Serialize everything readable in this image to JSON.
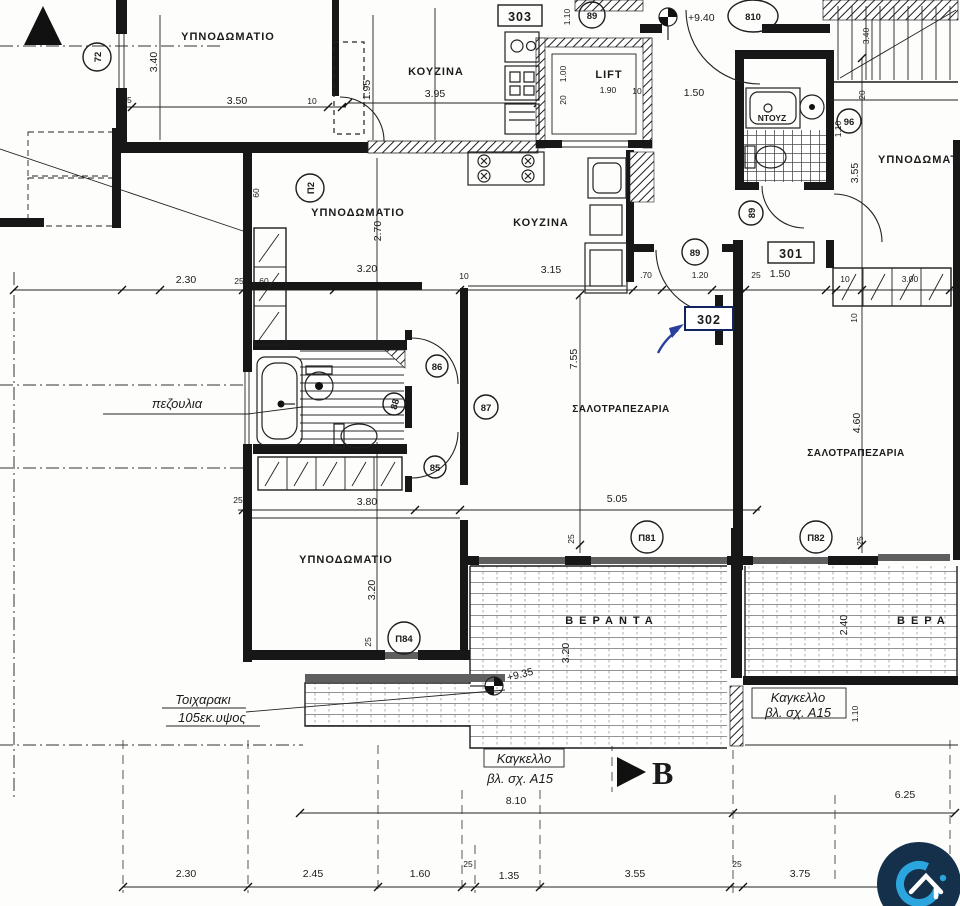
{
  "plan": {
    "rooms": {
      "bedroom_tl": "ΥΠΝΟΔΩΜΑΤΙΟ",
      "kitchen_tl": "ΚΟΥΖΙΝΑ",
      "lift": "LIFT",
      "shower_room": "ΝΤΟΥΖ",
      "bedroom_302": "ΥΠΝΟΔΩΜΑΤΙΟ",
      "kitchen_302": "ΚΟΥΖΙΝΑ",
      "living_302": "ΣΑΛΟΤΡΑΠΕΖΑΡΙΑ",
      "bedroom2_302": "ΥΠΝΟΔΩΜΑΤΙΟ",
      "bedroom_301": "ΥΠΝΟΔΩΜΑΤΙΟ",
      "living_301": "ΣΑΛΟΤΡΑΠΕΖΑΡΙΑ",
      "veranda_302": "ΒΕΡΑΝΤΑ",
      "veranda_301": "ΒΕΡΑ"
    },
    "unit_tags": {
      "a303": "303",
      "a301": "301",
      "a302": "302"
    },
    "circle_tags": {
      "c72": "72",
      "c89_top": "89",
      "c810": "810",
      "c96": "96",
      "c89_hall": "89",
      "c89_wc": "89",
      "cP2": "Π2",
      "c87": "87",
      "c86": "86",
      "c88": "88",
      "c85": "85",
      "cP81": "Π81",
      "cP82": "Π82",
      "cP84": "Π84"
    },
    "levels": {
      "upper": "+9.40",
      "lower": "+9.35"
    },
    "annotations": {
      "sill_note": "πεζουλια",
      "low_wall_1": "Τοιχαρακι",
      "low_wall_2": "105εκ.υψος",
      "railing_1": "Καγκελλο",
      "railing_2": "βλ. σχ. Α15",
      "railing2_1": "Καγκελλο",
      "railing2_2": "βλ. σχ. Α15",
      "section_b": "B"
    },
    "dims": [
      "3.40",
      "25",
      "3.50",
      "10",
      "1.95",
      "3.95",
      "1.10",
      "1.90",
      "10",
      "1.00",
      "20",
      "1.50",
      "3.40",
      "20",
      "3.55",
      "1.10",
      "2.30",
      "25",
      "60",
      "60",
      "2.70",
      "3.20",
      "10",
      "3.15",
      ".70",
      "1.20",
      "25",
      "1.50",
      "10",
      "3.00",
      "10",
      "7.55",
      "5.05",
      "4.60",
      "3.80",
      "25",
      "3.20",
      "25",
      "25",
      "25",
      "3.20",
      "2.40",
      "1.10",
      "8.10",
      "6.25",
      "2.30",
      "2.45",
      "1.60",
      "25",
      "1.35",
      "3.55",
      "25",
      "3.75"
    ]
  },
  "logo": {
    "icon": "home-in-c-logo",
    "navy": "#14304b",
    "cyan": "#2ba5de",
    "white": "#ffffff"
  }
}
